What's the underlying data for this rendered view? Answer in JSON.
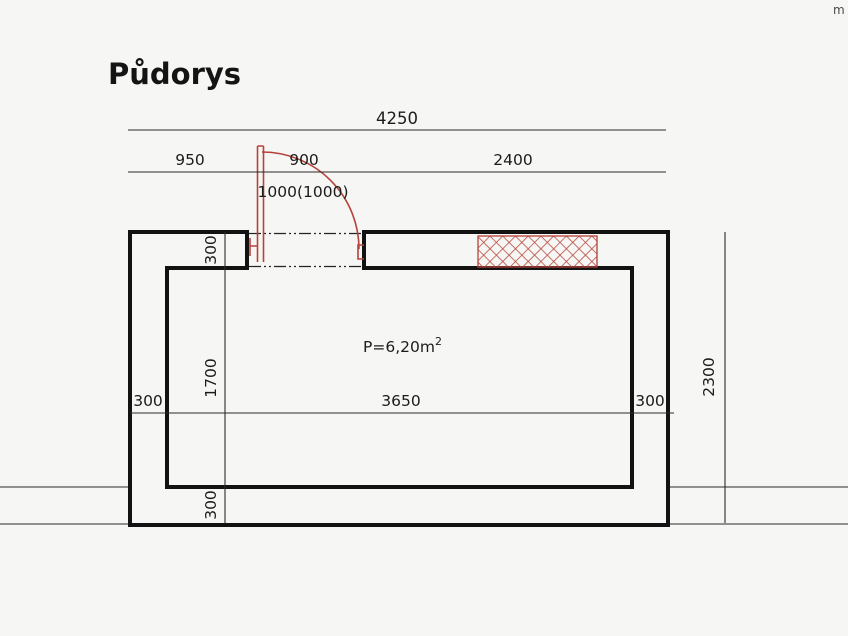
{
  "drawing": {
    "title": "Půdorys",
    "corner_fragment": "m",
    "area": {
      "value": "P=6,20m",
      "sup": "2"
    }
  },
  "dimensions": {
    "top_total": "4250",
    "seg_left": "950",
    "seg_door": "900",
    "seg_right": "2400",
    "door_detail": "1000(1000)",
    "inner_left_wall": "300",
    "inner_width": "3650",
    "inner_right_wall": "300",
    "wall_top": "300",
    "inner_height": "1700",
    "wall_bottom": "300",
    "side_total": "2300"
  },
  "colors": {
    "ink": "#1b1b1b",
    "accent_red": "#b6423a",
    "paper": "#f6f6f4"
  }
}
